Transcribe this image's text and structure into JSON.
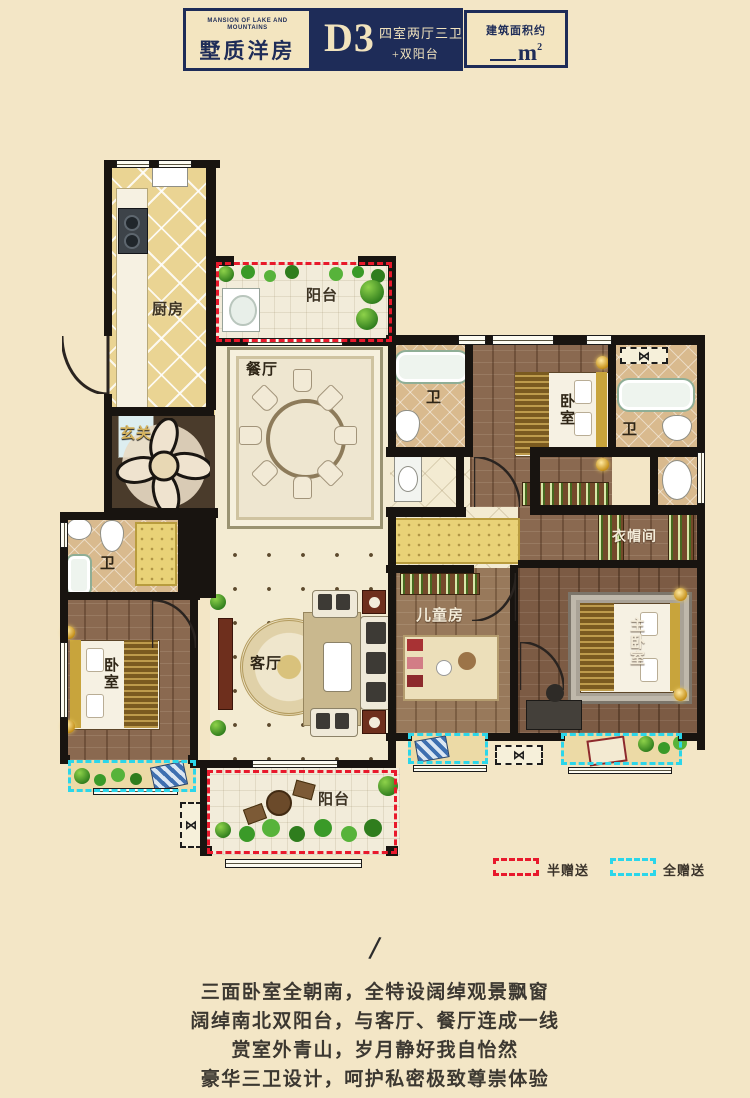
{
  "header": {
    "brand_en": "MANSION OF LAKE AND MOUNTAINS",
    "brand_cn": "墅质洋房",
    "unit_code": "D3",
    "unit_desc_line1": "四室两厅三卫",
    "unit_desc_line2": "+双阳台",
    "area_label": "建筑面积约",
    "area_unit": "m",
    "area_sup": "2",
    "navy_color": "#1e2c58",
    "cream_color": "#f3e5c0"
  },
  "rooms": {
    "kitchen": "厨房",
    "balcony_north": "阳台",
    "dining": "餐厅",
    "foyer": "玄关",
    "bath_top": "卫",
    "bedroom_top": "卧室",
    "bath_right": "卫",
    "cloakroom": "衣帽间",
    "bath_left": "卫",
    "bedroom_left": "卧室",
    "living": "客厅",
    "kids_room": "儿童房",
    "master_bedroom": "主卧室",
    "balcony_south": "阳台"
  },
  "legend": {
    "half_gift": "半赠送",
    "full_gift": "全赠送",
    "half_gift_color": "#e8192c",
    "full_gift_color": "#2bd6ea"
  },
  "description": {
    "divider": "/",
    "lines": [
      "三面卧室全朝南，全特设阔绰观景飘窗",
      "阔绰南北双阳台，与客厅、餐厅连成一线",
      "赏室外青山，岁月静好我自怡然",
      "豪华三卫设计，呵护私密极致尊崇体验"
    ]
  }
}
